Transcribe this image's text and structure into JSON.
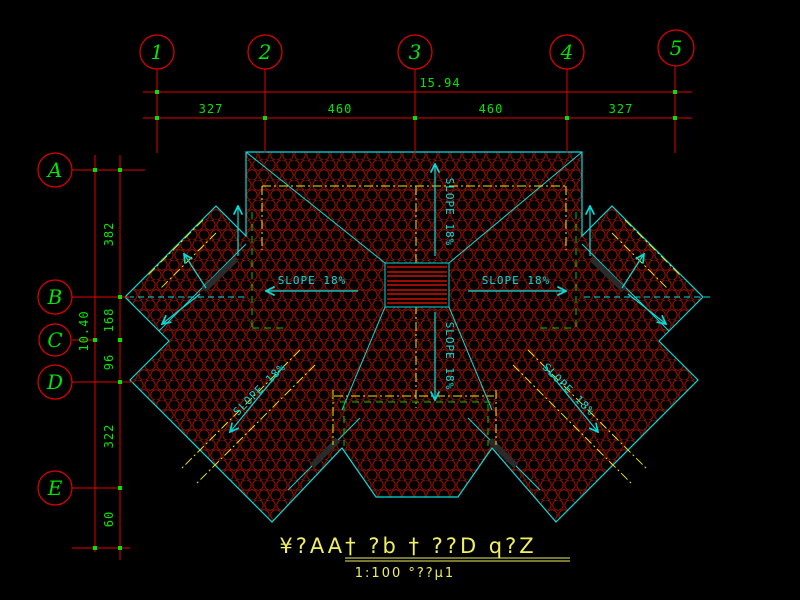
{
  "drawing": {
    "title_line1": "¥?AA† ?b † ??D q?Z",
    "title_line2": "1:100 °??µ1",
    "slope_label": "SLOPE 18%"
  },
  "grid": {
    "columns": [
      {
        "label": "1"
      },
      {
        "label": "2"
      },
      {
        "label": "3"
      },
      {
        "label": "4"
      },
      {
        "label": "5"
      }
    ],
    "rows": [
      {
        "label": "A"
      },
      {
        "label": "B"
      },
      {
        "label": "C"
      },
      {
        "label": "D"
      },
      {
        "label": "E"
      }
    ],
    "top_overall": "15.94",
    "top_segments": [
      "327",
      "460",
      "460",
      "327"
    ],
    "left_overall": "10.40",
    "left_segments": [
      "382",
      "168",
      "96",
      "322",
      "60"
    ]
  },
  "colors": {
    "background": "#000000",
    "grid_red": "#e60000",
    "hatch_red": "#9c1200",
    "dim_green": "#00e600",
    "outline_cyan": "#00dcdc",
    "dash_yellow": "#e8e800",
    "dash_green": "#00c400",
    "title_yellow": "#f0f060"
  }
}
